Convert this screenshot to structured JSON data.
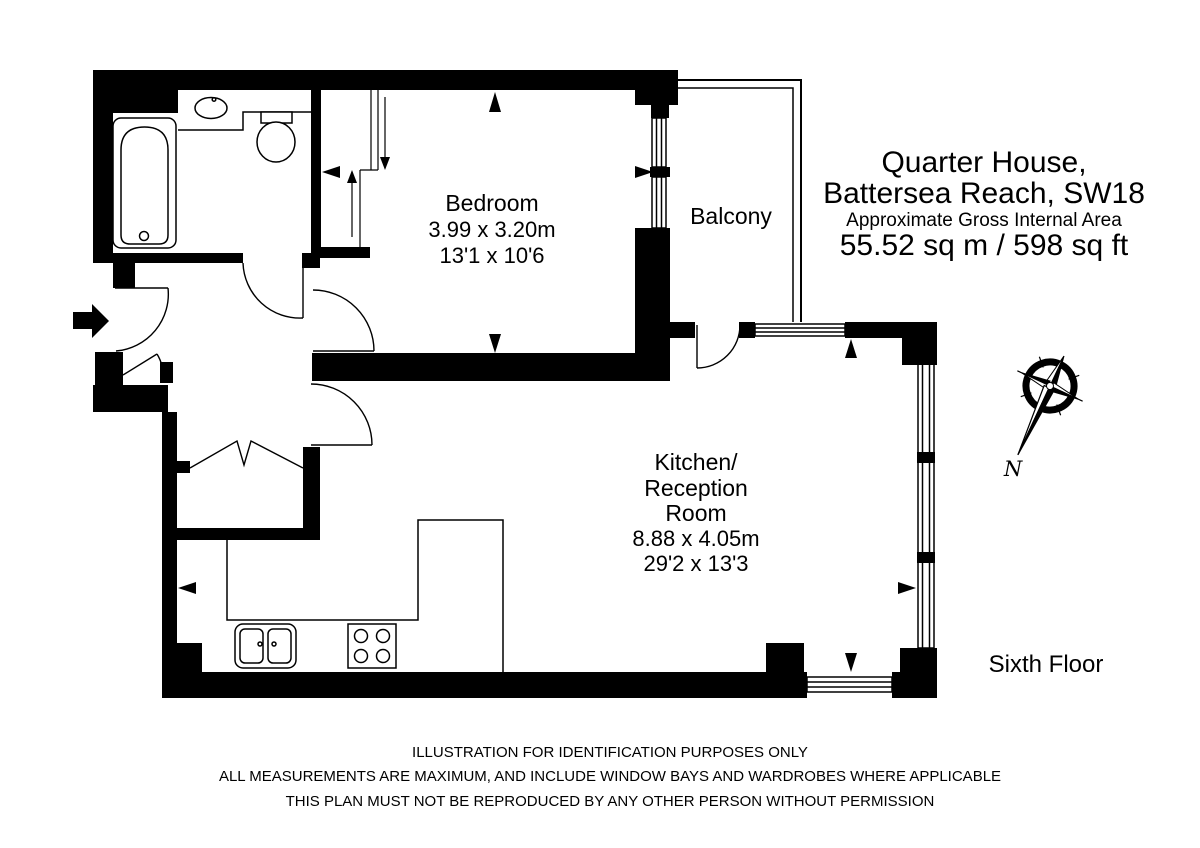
{
  "title": {
    "line1": "Quarter House,",
    "line2": "Battersea Reach, SW18",
    "line3": "Approximate Gross Internal Area",
    "line4": "55.52 sq m  /  598 sq ft"
  },
  "rooms": {
    "bedroom": {
      "name": "Bedroom",
      "metric": "3.99 x 3.20m",
      "imperial": "13'1 x 10'6"
    },
    "kitchen": {
      "name_line1": "Kitchen/",
      "name_line2": "Reception",
      "name_line3": "Room",
      "metric": "8.88 x 4.05m",
      "imperial": "29'2 x 13'3"
    },
    "balcony": {
      "name": "Balcony"
    }
  },
  "floor_label": "Sixth Floor",
  "compass": {
    "north_label": "N"
  },
  "disclaimer": {
    "line1": "ILLUSTRATION FOR IDENTIFICATION PURPOSES ONLY",
    "line2": "ALL MEASUREMENTS ARE MAXIMUM, AND INCLUDE WINDOW BAYS AND WARDROBES WHERE APPLICABLE",
    "line3": "THIS PLAN MUST NOT BE REPRODUCED BY ANY OTHER PERSON WITHOUT PERMISSION"
  },
  "colors": {
    "ink": "#000000",
    "background": "#ffffff"
  }
}
